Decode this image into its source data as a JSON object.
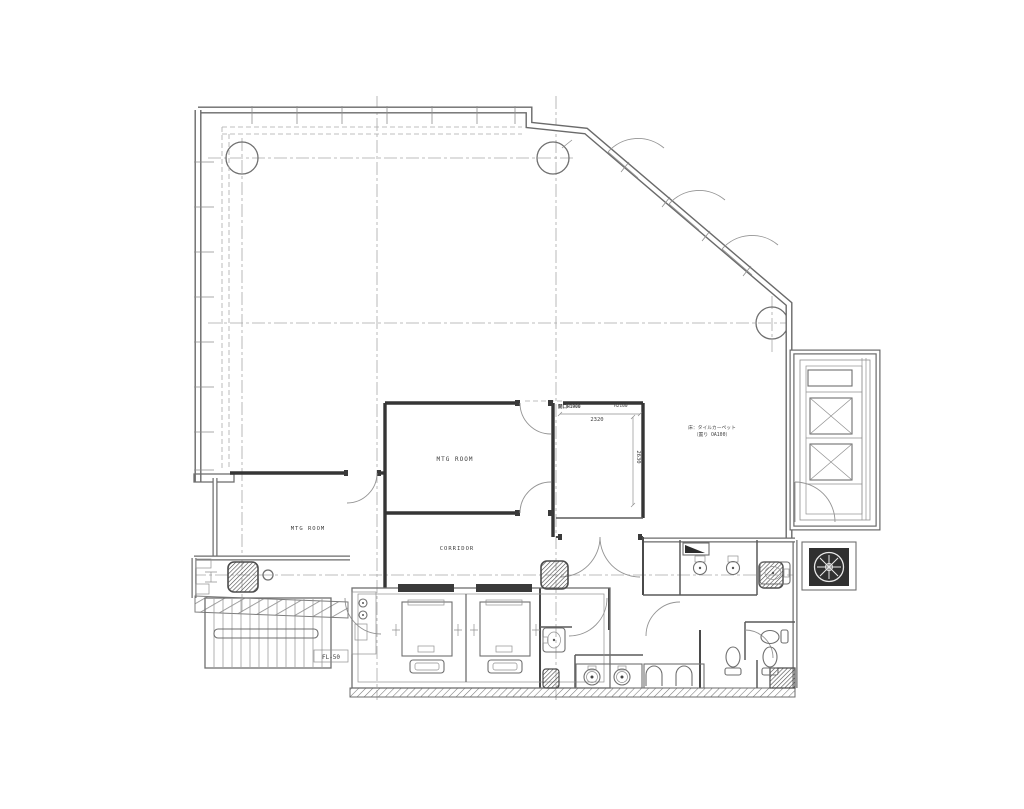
{
  "drawing": {
    "rooms": {
      "mtg_room_center": "MTG ROOM",
      "mtg_room_left": "MTG ROOM",
      "corridor": "CORRIDOR"
    },
    "annotations": {
      "floor_level": "FL-50",
      "floor_finish_line1": "床：タイルカーペット",
      "floor_finish_line2": "（置り OA100）",
      "opening_label": "開口H1900",
      "opening_height": "H2100"
    },
    "dimensions": {
      "width": "2320",
      "height": "2630"
    },
    "colors": {
      "background": "#ffffff",
      "line": "#8f8f8f",
      "wall": "#353535",
      "text": "#3e3e3e"
    }
  }
}
